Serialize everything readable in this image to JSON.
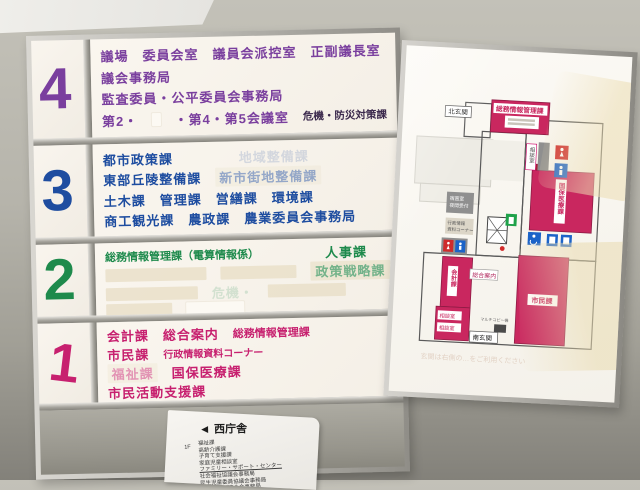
{
  "directory": {
    "floors": [
      {
        "number": "4",
        "color": "#7a3f9e",
        "rows": [
          {
            "segments": [
              {
                "t": "議場"
              },
              {
                "t": "委員会室"
              },
              {
                "t": "議員会派控室"
              },
              {
                "t": "正副議長室"
              }
            ]
          },
          {
            "segments": [
              {
                "t": "議会事務局"
              }
            ]
          },
          {
            "segments": [
              {
                "t": "監査委員・公平委員会事務局"
              }
            ]
          },
          {
            "segments": [
              {
                "t": "第2・"
              },
              {
                "patch": 30,
                "cls": "white"
              },
              {
                "t": "・第4・第5会議室"
              },
              {
                "t": "危機・防災対策課",
                "cls": "dark"
              }
            ]
          }
        ]
      },
      {
        "number": "3",
        "color": "#1e4da0",
        "rows": [
          {
            "segments": [
              {
                "t": "都市政策課"
              },
              {
                "t": "地域整備課",
                "cls": "ghost gap"
              }
            ]
          },
          {
            "segments": [
              {
                "t": "東部丘陵整備課"
              },
              {
                "t": "新市街地整備課",
                "cls": "ghostpatch"
              }
            ]
          },
          {
            "segments": [
              {
                "t": "土木課"
              },
              {
                "t": "管理課"
              },
              {
                "t": "営繕課"
              },
              {
                "t": "環境課"
              }
            ]
          },
          {
            "segments": [
              {
                "t": "商工観光課"
              },
              {
                "t": "農政課"
              },
              {
                "t": "農業委員会事務局"
              }
            ]
          }
        ]
      },
      {
        "number": "2",
        "color": "#1e8a4c",
        "rows": [
          {
            "segments": [
              {
                "t": "総務情報管理課（電算情報係）",
                "cls": "sub-strong"
              },
              {
                "t": "人事課",
                "cls": "gap"
              }
            ]
          },
          {
            "segments": [
              {
                "patch": 112
              },
              {
                "patch": 84
              },
              {
                "t": "政策戦略課",
                "cls": "onpatch"
              }
            ]
          },
          {
            "segments": [
              {
                "patch": 92
              },
              {
                "t": "危機・",
                "cls": "ghost"
              },
              {
                "patch": 78
              }
            ]
          },
          {
            "segments": [
              {
                "patch": 66
              },
              {
                "patch": 58,
                "cls": "white"
              }
            ]
          }
        ]
      },
      {
        "number": "1",
        "color": "#c7206f",
        "rows": [
          {
            "segments": [
              {
                "t": "会計課"
              },
              {
                "t": "総合案内"
              },
              {
                "t": "総務情報管理課",
                "cls": "sub-strong"
              }
            ]
          },
          {
            "segments": [
              {
                "t": "市民課"
              },
              {
                "t": "行政情報資料コーナー",
                "cls": "sub"
              }
            ]
          },
          {
            "segments": [
              {
                "t": "福祉課",
                "cls": "ghostpatch"
              },
              {
                "t": "国保医療課"
              }
            ]
          },
          {
            "segments": [
              {
                "t": "市民活動支援課"
              }
            ]
          }
        ]
      }
    ]
  },
  "map": {
    "rooms": {
      "somu": "総務情報管理課",
      "kokuho": "国保医療課",
      "shimin": "市民課",
      "kaikei": "会計課",
      "soudan_side": "相談室",
      "soudan_a": "相談室",
      "soudan_b": "相談室"
    },
    "labels": {
      "north": "北玄関",
      "south": "南玄関",
      "info": "総合案内",
      "night1": "宿直室",
      "night2": "夜間受付",
      "gyosei1": "行政情報",
      "gyosei2": "資料コーナー",
      "copy": "マルチコピー機",
      "notice": "玄関は右側の…をご利用ください"
    },
    "icon_colors": {
      "female_restroom": "#cf2b2b",
      "male_restroom": "#1b63c8",
      "accessible": "#1b63c8",
      "elevator": "#1b63c8",
      "stairs_green": "#1fa24a",
      "room_pink": "#c9275f"
    }
  },
  "paper": {
    "arrow": "◀",
    "header": "西庁舎",
    "floor": "1F",
    "items": [
      "福祉課",
      "高齢介護課",
      "子育て支援課",
      "家庭児童相談室",
      "ファミリー・サポート・センター",
      "社会福祉協議会事務局",
      "民生児童委員協議会事務局",
      "老人クラブ連合会事務局"
    ]
  }
}
